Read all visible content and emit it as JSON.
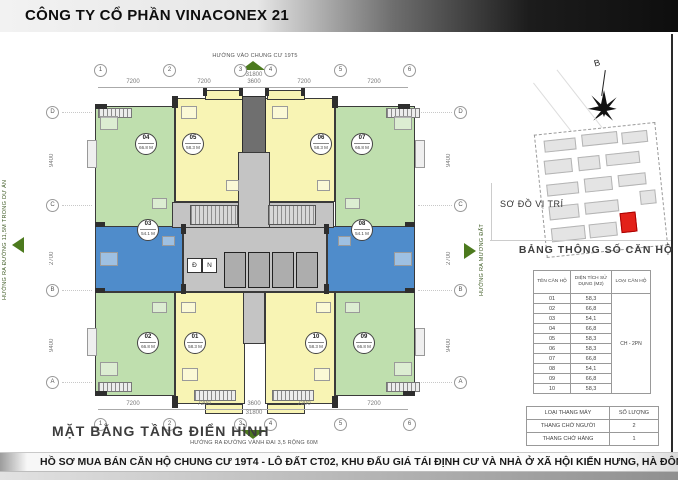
{
  "header": {
    "company": "CÔNG TY CỔ PHẦN VINACONEX 21"
  },
  "plan": {
    "title": "MẶT BẰNG TẦNG ĐIỂN HÌNH",
    "direction_top": "HƯỚNG VÀO CHUNG CƯ 19T5",
    "direction_bottom": "HƯỚNG RA ĐƯỜNG VÀNH ĐAI 3,5 RỘNG 60M",
    "direction_left": "HƯỚNG RA ĐƯỜNG 11,5M TRONG DỰ ÁN",
    "direction_right": "HƯỚNG RA MƯƠNG ĐẤT",
    "grid_cols": [
      "1",
      "2",
      "3",
      "4",
      "5",
      "6"
    ],
    "grid_rows": [
      "D",
      "C",
      "B",
      "A"
    ],
    "dims_top": [
      "7200",
      "7200",
      "3600",
      "7200",
      "7200"
    ],
    "dim_total": "31800",
    "dims_side": [
      "9400",
      "2700",
      "9400"
    ],
    "core_labels": {
      "d": "Đ",
      "n": "N"
    },
    "units": [
      {
        "no": "04",
        "area": "66.8 M",
        "color": "green"
      },
      {
        "no": "05",
        "area": "58.3 M",
        "color": "yellow"
      },
      {
        "no": "06",
        "area": "58.3 M",
        "color": "yellow"
      },
      {
        "no": "07",
        "area": "66.8 M",
        "color": "green"
      },
      {
        "no": "03",
        "area": "54.1 M",
        "color": "blue"
      },
      {
        "no": "08",
        "area": "54.1 M",
        "color": "blue"
      },
      {
        "no": "02",
        "area": "66.8 M",
        "color": "green"
      },
      {
        "no": "01",
        "area": "58.3 M",
        "color": "yellow"
      },
      {
        "no": "10",
        "area": "58.3 M",
        "color": "yellow"
      },
      {
        "no": "09",
        "area": "66.8 M",
        "color": "green"
      }
    ]
  },
  "sidebar": {
    "north_label": "B",
    "site_map_title": "SƠ ĐỒ VỊ TRÍ",
    "spec_table": {
      "title": "BẢNG THÔNG SỐ CĂN HỘ",
      "headers": [
        "TÊN CĂN HỘ",
        "DIỆN TÍCH SỬ DỤNG (M2)",
        "LOẠI CĂN HỘ"
      ],
      "type_all": "CH - 2PN",
      "rows": [
        [
          "01",
          "58,3"
        ],
        [
          "02",
          "66,8"
        ],
        [
          "03",
          "54,1"
        ],
        [
          "04",
          "66,8"
        ],
        [
          "05",
          "58,3"
        ],
        [
          "06",
          "58,3"
        ],
        [
          "07",
          "66,8"
        ],
        [
          "08",
          "54,1"
        ],
        [
          "09",
          "66,8"
        ],
        [
          "10",
          "58,3"
        ]
      ]
    },
    "lift_table": {
      "headers": [
        "LOẠI THANG MÁY",
        "SỐ LƯỢNG"
      ],
      "rows": [
        [
          "THANG CHỞ NGƯỜI",
          "2"
        ],
        [
          "THANG CHỞ HÀNG",
          "1"
        ]
      ]
    }
  },
  "footer": {
    "text": "HỒ SƠ MUA BÁN CĂN HỘ CHUNG CƯ 19T4 - LÔ ĐẤT CT02, KHU ĐẤU GIÁ TÁI ĐỊNH CƯ VÀ NHÀ Ở XÃ HỘI KIẾN HƯNG, HÀ ĐÔNG , HÀ NỘI"
  },
  "colors": {
    "unit_green": "#bfdfae",
    "unit_yellow": "#f8f4b4",
    "unit_blue": "#4f8ccb",
    "arrow_green": "#4c7a1e",
    "highlight_red": "#e32119",
    "banner_dark": "#0e0e0e"
  }
}
